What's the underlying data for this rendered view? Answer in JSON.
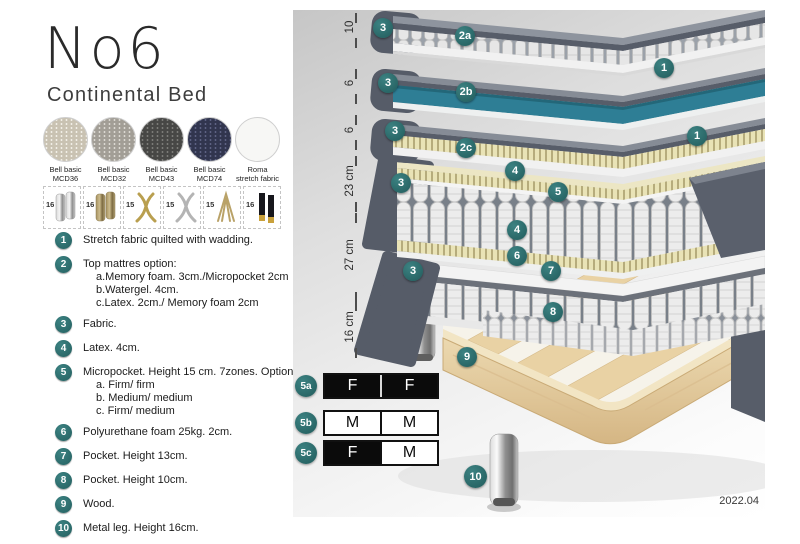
{
  "header": {
    "title": "No6",
    "subtitle": "Continental Bed"
  },
  "colors": {
    "accent_teal": "#2e6f6f",
    "watergel_teal": "#2e7e95",
    "shell_gray": "#575d69",
    "latex_cream": "#e9e3b6",
    "wood": "#e5cfa2",
    "table_black": "#0b0b0b"
  },
  "fabrics": [
    {
      "line1": "Bell basic",
      "line2": "MCD36"
    },
    {
      "line1": "Bell basic",
      "line2": "MCD32"
    },
    {
      "line1": "Bell basic",
      "line2": "MCD43"
    },
    {
      "line1": "Bell basic",
      "line2": "MCD74"
    },
    {
      "line1": "Roma",
      "line2": "stretch fabric"
    }
  ],
  "leg_options": [
    {
      "size": "16"
    },
    {
      "size": "16"
    },
    {
      "size": "15"
    },
    {
      "size": "15"
    },
    {
      "size": "15"
    },
    {
      "size": "16"
    }
  ],
  "legend": [
    {
      "num": "1",
      "text": "Stretch fabric quilted with wadding."
    },
    {
      "num": "2",
      "text": "Top mattres option:",
      "sub": [
        "a.Memory foam. 3cm./Micropocket 2cm",
        "b.Watergel. 4cm.",
        "c.Latex. 2cm./ Memory foam 2cm"
      ]
    },
    {
      "num": "3",
      "text": "Fabric."
    },
    {
      "num": "4",
      "text": "Latex. 4cm."
    },
    {
      "num": "5",
      "text": "Micropocket. Height 15 cm. 7zones. Option:",
      "sub": [
        "a. Firm/ firm",
        "b. Medium/ medium",
        "c. Firm/ medium"
      ]
    },
    {
      "num": "6",
      "text": "Polyurethane foam 25kg. 2cm."
    },
    {
      "num": "7",
      "text": "Pocket. Height 13cm."
    },
    {
      "num": "8",
      "text": "Pocket. Height 10cm."
    },
    {
      "num": "9",
      "text": "Wood."
    },
    {
      "num": "10",
      "text": "Metal leg. Height 16cm."
    }
  ],
  "diagram": {
    "ruler": [
      "10",
      "6",
      "6",
      "23 cm",
      "27 cm",
      "16 cm"
    ],
    "badges": [
      {
        "label": "3"
      },
      {
        "label": "2a"
      },
      {
        "label": "1"
      },
      {
        "label": "3"
      },
      {
        "label": "2b"
      },
      {
        "label": "3"
      },
      {
        "label": "2c"
      },
      {
        "label": "1"
      },
      {
        "label": "3"
      },
      {
        "label": "4"
      },
      {
        "label": "5"
      },
      {
        "label": "4"
      },
      {
        "label": "6"
      },
      {
        "label": "7"
      },
      {
        "label": "3"
      },
      {
        "label": "8"
      },
      {
        "label": "9"
      },
      {
        "label": "10"
      }
    ],
    "firmness": [
      {
        "id": "5a",
        "cells": [
          {
            "t": "F"
          },
          {
            "t": "F"
          }
        ]
      },
      {
        "id": "5b",
        "cells": [
          {
            "t": "M"
          },
          {
            "t": "M"
          }
        ]
      },
      {
        "id": "5c",
        "cells": [
          {
            "t": "F"
          },
          {
            "t": "M"
          }
        ]
      }
    ],
    "version": "2022.04"
  }
}
